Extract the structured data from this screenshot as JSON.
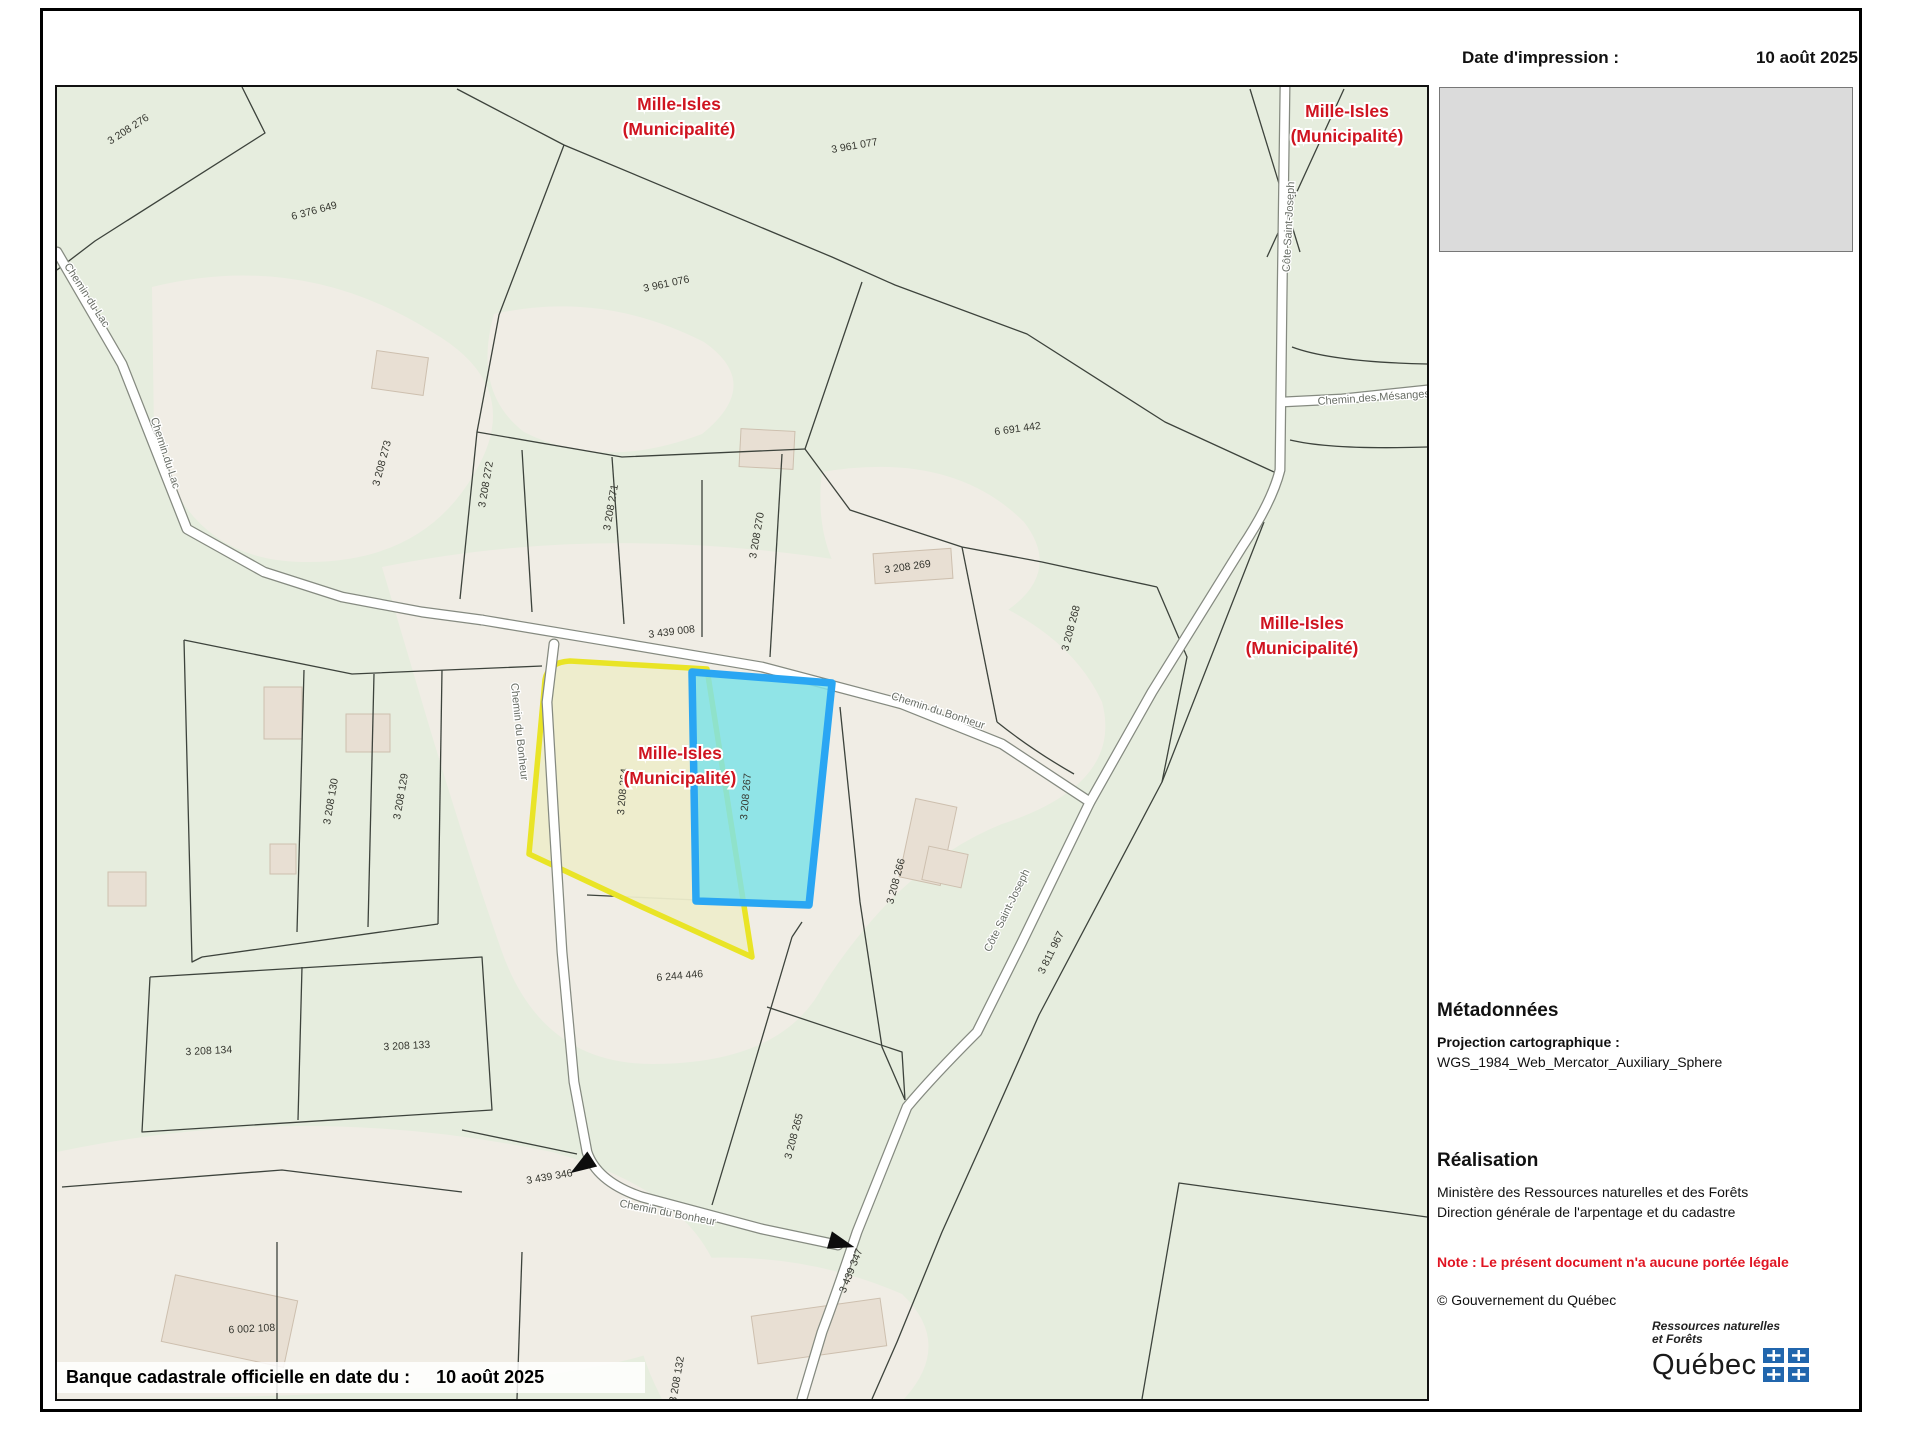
{
  "header": {
    "date_label": "Date d'impression :",
    "date_value": "10 août 2025"
  },
  "footer_bar": {
    "label": "Banque cadastrale officielle en date du :",
    "date": "10 août 2025"
  },
  "metadata_panel": {
    "heading": "Métadonnées",
    "projection_label": "Projection cartographique :",
    "projection_value": "WGS_1984_Web_Mercator_Auxiliary_Sphere"
  },
  "realisation_panel": {
    "heading": "Réalisation",
    "line1": "Ministère des Ressources naturelles et des Forêts",
    "line2": "Direction générale de l'arpentage et du cadastre",
    "note": "Note : Le présent document n'a aucune portée légale",
    "copyright": "© Gouvernement du Québec"
  },
  "logo": {
    "line1": "Ressources naturelles",
    "line2": "et Forêts",
    "wordmark": "Québec"
  },
  "colors": {
    "municipality_red": "#cf1420",
    "note_red": "#e01422",
    "highlight_yellow": "#e9e426",
    "highlight_blue": "#2aa6f3",
    "highlight_cyan_fill": "#7fe2e8",
    "map_green": "#e6edde",
    "map_pale": "#f0ede5",
    "legend_gray": "#dbdbdb",
    "flag_blue": "#2166ad"
  },
  "map": {
    "municipality_labels": [
      {
        "line1": "Mille-Isles",
        "line2": "(Municipalité)",
        "x": 677,
        "y": 108
      },
      {
        "line1": "Mille-Isles",
        "line2": "(Municipalité)",
        "x": 1345,
        "y": 115
      },
      {
        "line1": "Mille-Isles",
        "line2": "(Municipalité)",
        "x": 678,
        "y": 757
      },
      {
        "line1": "Mille-Isles",
        "line2": "(Municipalité)",
        "x": 1300,
        "y": 627
      }
    ],
    "road_labels": [
      {
        "name": "Chemin du Lac",
        "x": 82,
        "y": 295,
        "rot": 57
      },
      {
        "name": "Chemin du Lac",
        "x": 160,
        "y": 452,
        "rot": 72
      },
      {
        "name": "Chemin du Bonheur",
        "x": 935,
        "y": 712,
        "rot": 18
      },
      {
        "name": "Chemin du Bonheur",
        "x": 514,
        "y": 730,
        "rot": 84
      },
      {
        "name": "Chemin du Bonheur",
        "x": 665,
        "y": 1214,
        "rot": 11
      },
      {
        "name": "Côte Saint-Joseph",
        "x": 1290,
        "y": 225,
        "rot": -87
      },
      {
        "name": "Côte Saint-Joseph",
        "x": 1008,
        "y": 910,
        "rot": -64
      },
      {
        "name": "Chemin des Mésanges",
        "x": 1372,
        "y": 399,
        "rot": -4
      }
    ],
    "lot_labels": [
      {
        "lot": "3 208 276",
        "x": 128,
        "y": 130,
        "rot": -33
      },
      {
        "lot": "6 376 649",
        "x": 313,
        "y": 212,
        "rot": -15
      },
      {
        "lot": "3 961 077",
        "x": 853,
        "y": 147,
        "rot": -10
      },
      {
        "lot": "3 961 076",
        "x": 665,
        "y": 285,
        "rot": -12
      },
      {
        "lot": "6 691 442",
        "x": 1016,
        "y": 430,
        "rot": -8
      },
      {
        "lot": "3 208 273",
        "x": 383,
        "y": 462,
        "rot": -75
      },
      {
        "lot": "3 208 272",
        "x": 487,
        "y": 483,
        "rot": -80
      },
      {
        "lot": "3 208 271",
        "x": 612,
        "y": 506,
        "rot": -80
      },
      {
        "lot": "3 208 270",
        "x": 758,
        "y": 534,
        "rot": -80
      },
      {
        "lot": "3 208 269",
        "x": 906,
        "y": 568,
        "rot": -8
      },
      {
        "lot": "3 439 008",
        "x": 670,
        "y": 633,
        "rot": -7
      },
      {
        "lot": "3 208 268",
        "x": 1072,
        "y": 627,
        "rot": -75
      },
      {
        "lot": "3 208 264",
        "x": 624,
        "y": 790,
        "rot": -85
      },
      {
        "lot": "3 208 267",
        "x": 747,
        "y": 795,
        "rot": -85
      },
      {
        "lot": "3 208 266",
        "x": 897,
        "y": 880,
        "rot": -75
      },
      {
        "lot": "3 208 130",
        "x": 332,
        "y": 800,
        "rot": -80
      },
      {
        "lot": "3 208 129",
        "x": 402,
        "y": 795,
        "rot": -80
      },
      {
        "lot": "6 244 446",
        "x": 678,
        "y": 977,
        "rot": -5
      },
      {
        "lot": "3 208 134",
        "x": 207,
        "y": 1052,
        "rot": -3
      },
      {
        "lot": "3 208 133",
        "x": 405,
        "y": 1047,
        "rot": -3
      },
      {
        "lot": "3 811 967",
        "x": 1052,
        "y": 952,
        "rot": -64
      },
      {
        "lot": "3 208 265",
        "x": 795,
        "y": 1135,
        "rot": -75
      },
      {
        "lot": "3 439 346",
        "x": 548,
        "y": 1178,
        "rot": -10
      },
      {
        "lot": "3 439 347",
        "x": 852,
        "y": 1270,
        "rot": -68
      },
      {
        "lot": "6 002 108",
        "x": 250,
        "y": 1330,
        "rot": -3
      },
      {
        "lot": "3 208 132",
        "x": 678,
        "y": 1378,
        "rot": -80
      }
    ],
    "highlights": {
      "yellow_lot": "3 208 264",
      "cyan_lot": "3 208 267"
    }
  }
}
